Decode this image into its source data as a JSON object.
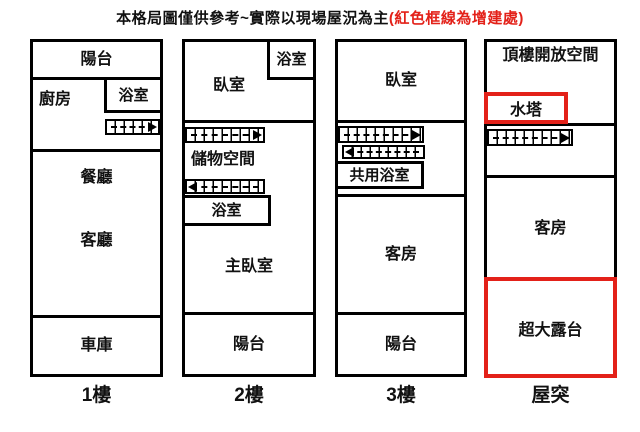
{
  "title": {
    "main": "本格局圖僅供參考~實際以現場屋況為主",
    "note": "(紅色框線為增建處)"
  },
  "colors": {
    "wall": "#000000",
    "addition": "#e32119",
    "background": "#ffffff",
    "text": "#111111"
  },
  "icons": {
    "stairs": "staircase treads with dashed walk-line and direction arrow"
  },
  "floors": [
    {
      "label": "1樓",
      "rooms": {
        "balcony": "陽台",
        "kitchen": "廚房",
        "bath": "浴室",
        "dining": "餐廳",
        "living": "客廳",
        "garage": "車庫"
      }
    },
    {
      "label": "2樓",
      "rooms": {
        "bedroom": "臥室",
        "bath_top": "浴室",
        "storage": "儲物空間",
        "bath_mid": "浴室",
        "master": "主臥室",
        "balcony": "陽台"
      }
    },
    {
      "label": "3樓",
      "rooms": {
        "bedroom": "臥室",
        "shared_bath": "共用浴室",
        "guest": "客房",
        "balcony": "陽台"
      }
    },
    {
      "label": "屋突",
      "rooms": {
        "open_space": "頂樓開放空間",
        "water_tower": "水塔",
        "guest": "客房",
        "terrace": "超大露台"
      }
    }
  ]
}
